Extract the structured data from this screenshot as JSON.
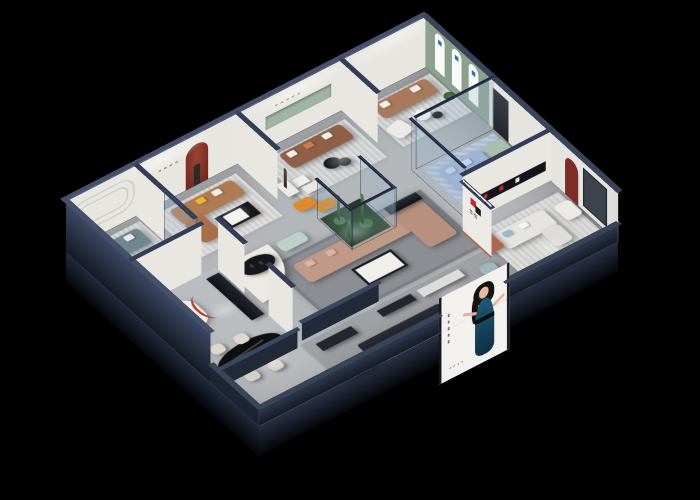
{
  "scene": {
    "type": "3d-isometric-cutaway-render",
    "subject": "furniture showroom interior dollhouse view",
    "background": "#000000"
  },
  "brand": {
    "name": "华悦",
    "sign_text": "华悦",
    "logo_red": "#c0272d",
    "logo_dark": "#1b1c1e"
  },
  "palette": {
    "outer_wall": "#2a3349",
    "wall_cap": "#3a445e",
    "interior_wall": "#e8e6e0",
    "floor": "#b4b7ba",
    "green_accent_wall": "#8ca08e",
    "red_arch": "#7e2d26",
    "terracotta": "#b0654d",
    "glass": "rgba(150,180,205,0.3)"
  },
  "poster": {
    "background": "#f2f1ee",
    "subject": "woman in dark blue evening dress",
    "dress_color": "#17506a"
  },
  "gallery_banners": {
    "count": 3,
    "shape": "arch",
    "color": "#ffffff",
    "logo_color": "#2a6fb8"
  },
  "rooms": [
    {
      "name": "left-lounge",
      "sofa": "teal-grey",
      "pillows": [
        "white",
        "orange"
      ],
      "feature": "rounded wall molding"
    },
    {
      "name": "back-left-lounge",
      "sofa": "caramel-leather-sectional",
      "pillows": [
        "yellow",
        "white"
      ],
      "feature": "red arch niche with sculpture"
    },
    {
      "name": "back-center-lounge",
      "sofa": "brown-leather",
      "feature": "bronze statue, green wall niche, orange bench"
    },
    {
      "name": "back-right-gallery",
      "sofa": "tan-leather",
      "feature": "green wall with three white arch banners"
    },
    {
      "name": "glass-bedroom",
      "bed": "periwinkle-blue",
      "sofa": "sage-green"
    },
    {
      "name": "right-lounge",
      "sofas": "white",
      "feature": "red arch niche, dark window, black display shelf"
    },
    {
      "name": "display-nook",
      "feature": "arched shelf niche, red arc lamp, black cabinet"
    },
    {
      "name": "dining",
      "table": "black-marble-oval",
      "chairs": 4,
      "feature": "red arc floor lamp"
    },
    {
      "name": "center-living",
      "sofa": "blush-sectional",
      "feature": "curved white partition, cactus glass atrium, mint bench"
    },
    {
      "name": "reception",
      "counter_sign": "华悦",
      "features": [
        "black round table",
        "slate poufs",
        "blue patterned rug",
        "light-blue sofa"
      ]
    }
  ]
}
